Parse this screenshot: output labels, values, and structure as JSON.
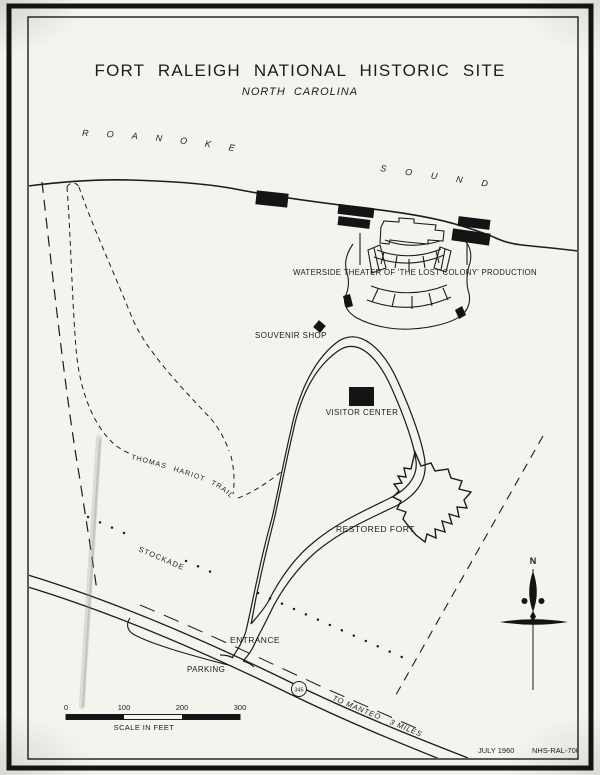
{
  "page": {
    "title": "FORT RALEIGH NATIONAL HISTORIC SITE",
    "subtitle": "NORTH CAROLINA"
  },
  "water": {
    "roanoke": "ROANOKE",
    "sound": "SOUND"
  },
  "features": {
    "theater_label": "WATERSIDE THEATER OF 'THE LOST COLONY' PRODUCTION",
    "souvenir_shop_label": "SOUVENIR SHOP",
    "visitor_center_label": "VISITOR CENTER",
    "restored_fort_label": "RESTORED FORT",
    "trail_label": "THOMAS HARIOT TRAIL",
    "stockade_label": "STOCKADE",
    "entrance_label": "ENTRANCE",
    "parking_label": "PARKING"
  },
  "road": {
    "route_number": "345",
    "destination": "TO MANTEO",
    "distance": "3 MILES"
  },
  "compass": {
    "north": "N"
  },
  "scale_bar": {
    "ticks": [
      "0",
      "100",
      "200",
      "300"
    ],
    "caption": "SCALE IN FEET"
  },
  "footer": {
    "date": "JULY 1960",
    "sheet_number": "NHS-RAL-7003"
  },
  "colors": {
    "ink": "#1c1c1c",
    "paper": "#f5f3ee"
  }
}
